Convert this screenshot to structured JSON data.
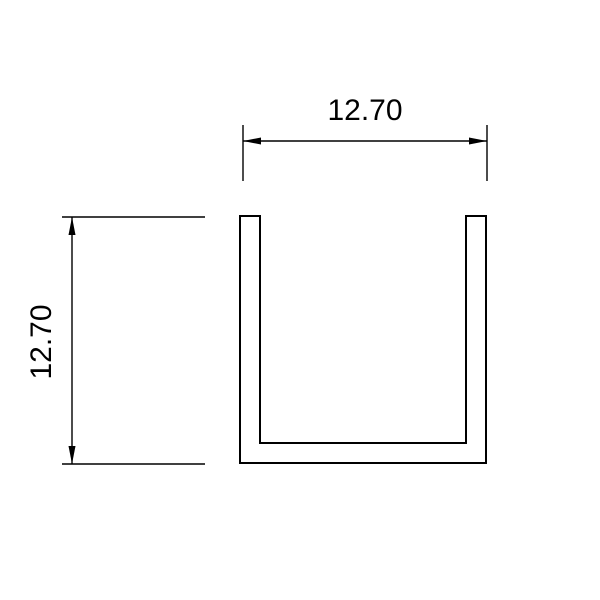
{
  "drawing": {
    "background_color": "#ffffff",
    "line_color": "#000000",
    "shape": "u-channel-profile-cross-section",
    "dimensions": {
      "width": {
        "label": "12.70"
      },
      "height": {
        "label": "12.70"
      }
    }
  }
}
